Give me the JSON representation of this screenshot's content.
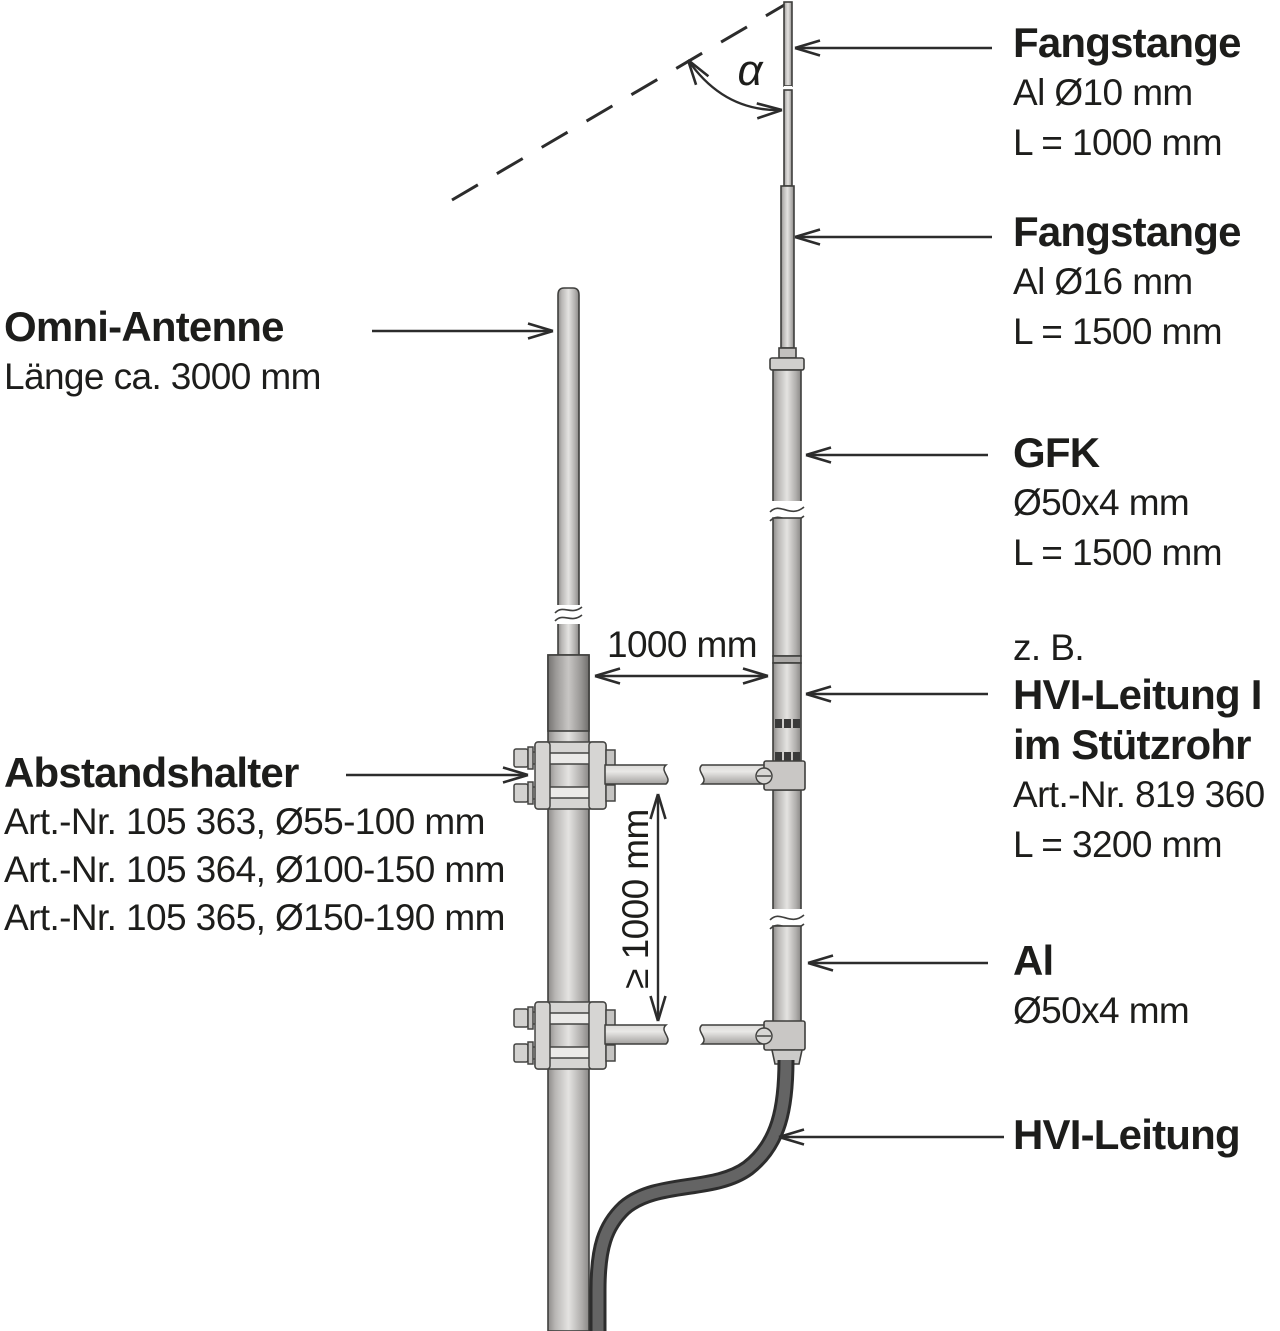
{
  "diagram_title": "Fangstange mit HVI-Leitung neben Omni-Antenne",
  "annotations": {
    "angle": "α",
    "dim_horizontal": "1000 mm",
    "dim_vertical": "≥ 1000 mm"
  },
  "left_labels": {
    "omni": {
      "title": "Omni-Antenne",
      "line1": "Länge ca. 3000 mm"
    },
    "abstandshalter": {
      "title": "Abstandshalter",
      "line1": "Art.-Nr. 105 363, Ø55-100 mm",
      "line2": "Art.-Nr. 105 364, Ø100-150 mm",
      "line3": "Art.-Nr. 105 365, Ø150-190 mm"
    }
  },
  "right_labels": {
    "fangstange10": {
      "title": "Fangstange",
      "line1": "Al Ø10 mm",
      "line2": "L = 1000 mm"
    },
    "fangstange16": {
      "title": "Fangstange",
      "line1": "Al Ø16 mm",
      "line2": "L = 1500 mm"
    },
    "gfk": {
      "title": "GFK",
      "line1": "Ø50x4 mm",
      "line2": "L = 1500 mm"
    },
    "hvi_stuetzrohr": {
      "pre": "z. B.",
      "title": "HVI-Leitung I",
      "title2": "im Stützrohr",
      "line1": "Art.-Nr. 819 360",
      "line2": "L = 3200 mm"
    },
    "al": {
      "title": "Al",
      "line1": "Ø50x4 mm"
    },
    "hvi": {
      "title": "HVI-Leitung"
    }
  },
  "colors": {
    "background": "#ffffff",
    "text": "#1d1d1b",
    "outline": "#3f3f3d",
    "tube_light": "#e4e3e1",
    "tube_mid": "#b3b1af",
    "tube_dark": "#8a8886",
    "clamp_fill": "#d6d5d3",
    "cable_outline": "#2d2d2d",
    "cable_fill": "#646464",
    "hash_mark": "#3a3a3a"
  }
}
